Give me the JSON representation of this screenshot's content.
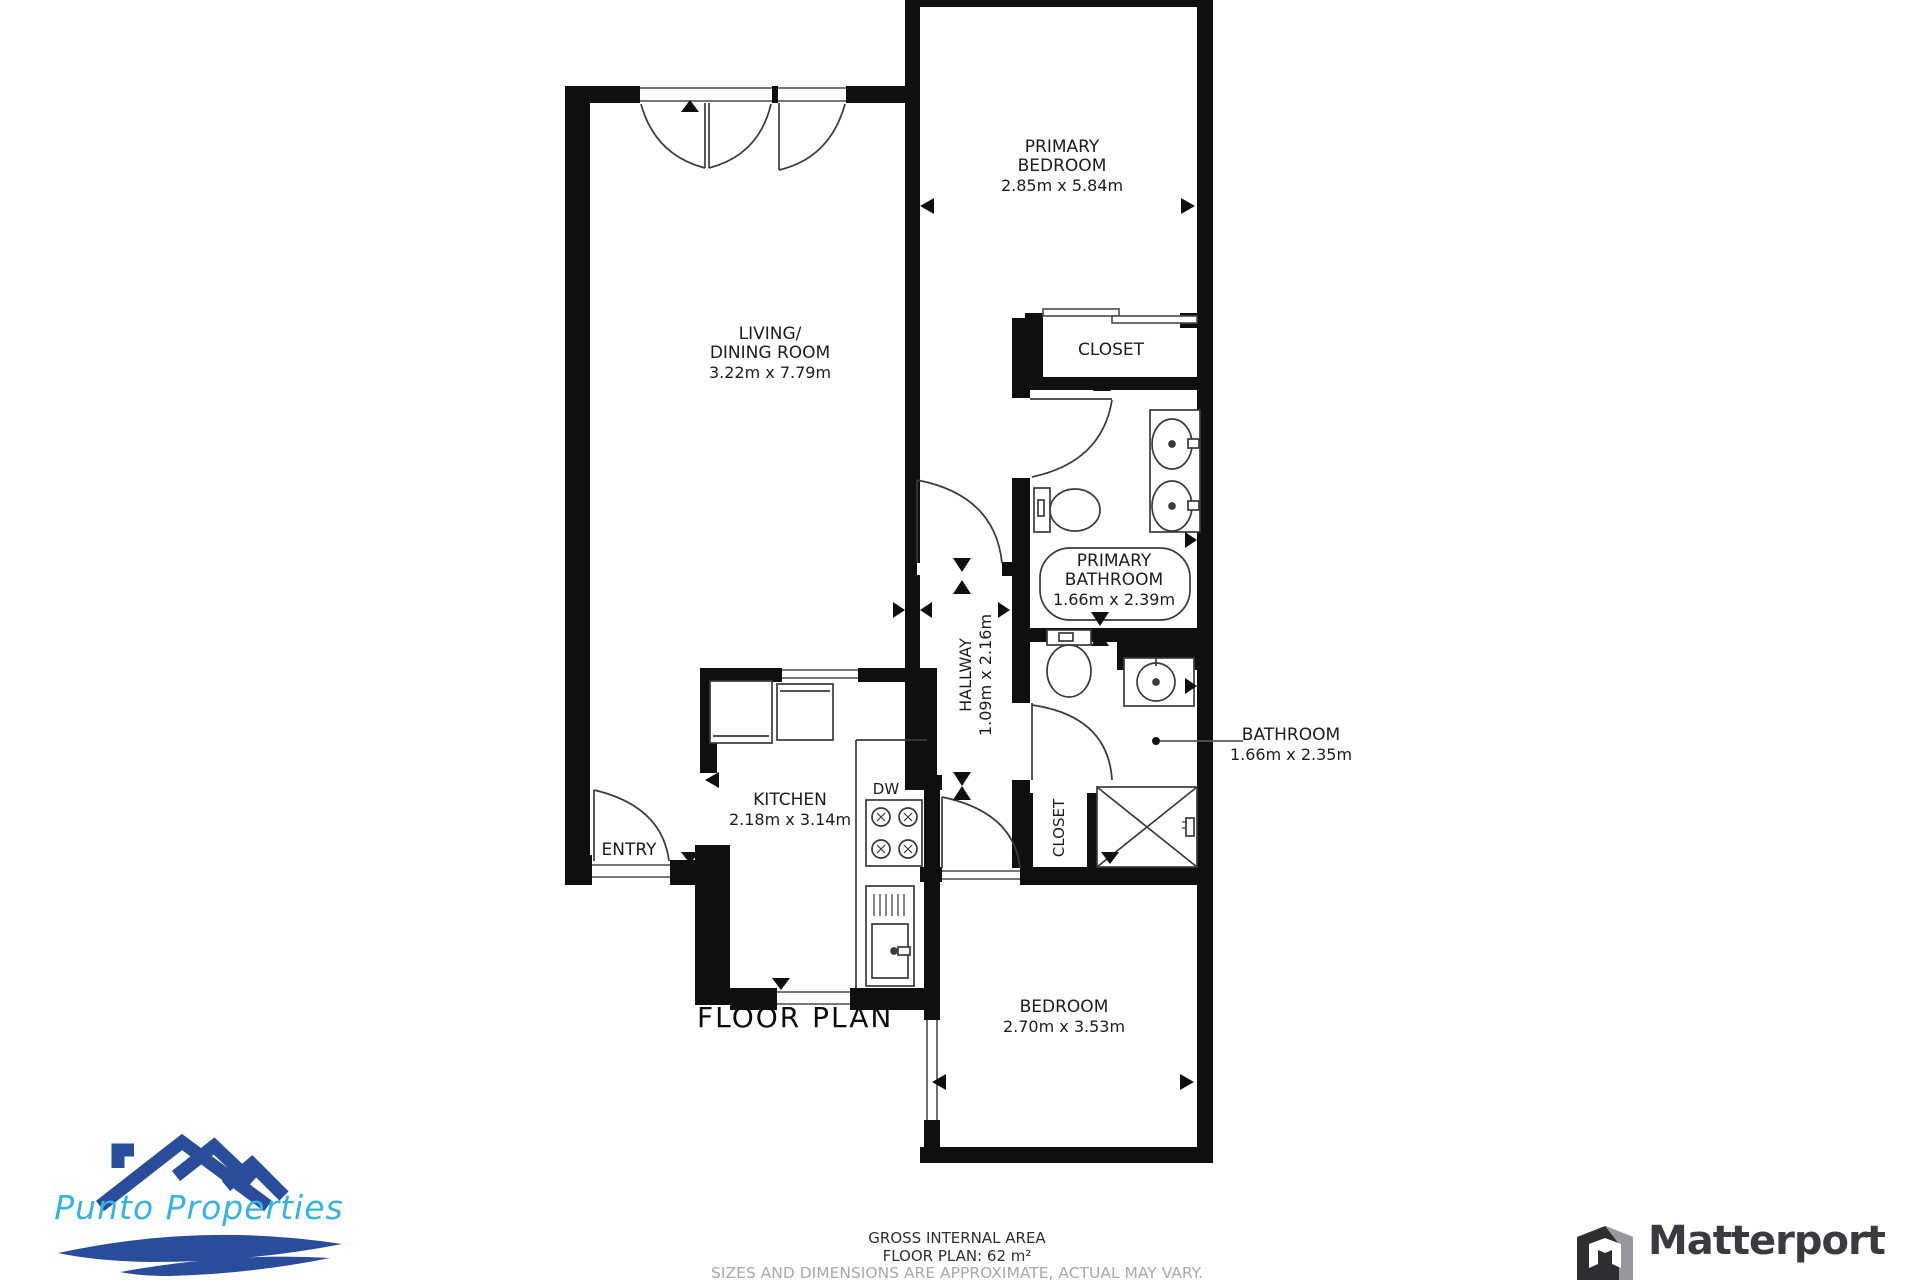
{
  "floor_plan": {
    "title": "FLOOR PLAN",
    "rooms": {
      "primary_bedroom": {
        "line1": "PRIMARY",
        "line2": "BEDROOM",
        "dims": "2.85m x 5.84m"
      },
      "living_dining": {
        "line1": "LIVING/",
        "line2": "DINING ROOM",
        "dims": "3.22m x 7.79m"
      },
      "primary_closet": {
        "label": "CLOSET"
      },
      "primary_bathroom": {
        "line1": "PRIMARY",
        "line2": "BATHROOM",
        "dims": "1.66m x 2.39m"
      },
      "hallway": {
        "line1": "HALLWAY",
        "dims": "1.09m x 2.16m"
      },
      "bathroom": {
        "line1": "BATHROOM",
        "dims": "1.66m x 2.35m"
      },
      "kitchen": {
        "line1": "KITCHEN",
        "dims": "2.18m x 3.14m"
      },
      "hall_closet": {
        "label": "CLOSET"
      },
      "bedroom": {
        "line1": "BEDROOM",
        "dims": "2.70m x 3.53m"
      },
      "entry": {
        "label": "ENTRY"
      },
      "dishwasher": {
        "label": "DW"
      }
    },
    "footer": {
      "line1": "GROSS INTERNAL AREA",
      "line2": "FLOOR PLAN: 62 m²",
      "line3": "SIZES AND DIMENSIONS ARE APPROXIMATE, ACTUAL MAY VARY."
    }
  },
  "branding": {
    "punto": {
      "name": "Punto Properties",
      "roof_color": "#2a4d9b",
      "text_color": "#35b4e2"
    },
    "matterport": {
      "name": "Matterport",
      "text_color": "#3a3a40"
    }
  },
  "colors": {
    "wall": "#0f0f0f",
    "line": "#3a3a3a",
    "muted_text": "#a9a9a9"
  }
}
